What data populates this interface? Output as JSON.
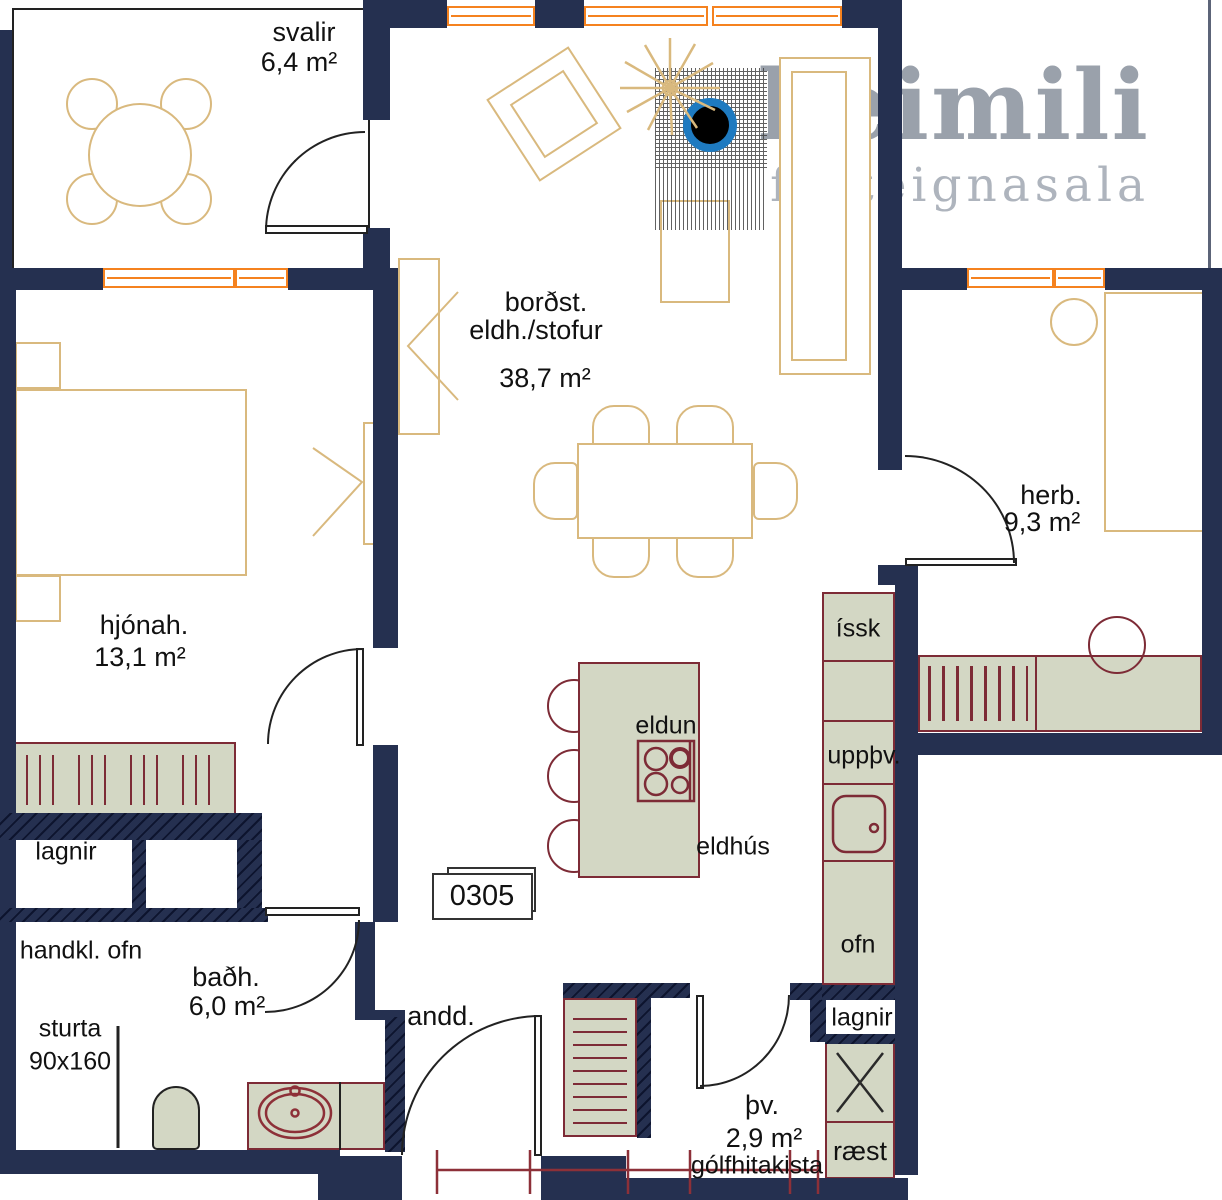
{
  "brand": {
    "name": "heimili",
    "tagline": "fasteignasala"
  },
  "labels": {
    "svalir": "svalir",
    "svalir_area": "6,4 m²",
    "living_1": "borðst.",
    "living_2": "eldh./stofur",
    "living_area": "38,7 m²",
    "hjonah": "hjónah.",
    "hjonah_area": "13,1 m²",
    "herb": "herb.",
    "herb_area": "9,3 m²",
    "badh": "baðh.",
    "badh_area": "6,0 m²",
    "thv": "þv.",
    "thv_area": "2,9 m²",
    "andd": "andd.",
    "issk": "íssk",
    "uppthv": "uppþv.",
    "ofn": "ofn",
    "eldun": "eldun",
    "eldhus": "eldhús",
    "lagnir_left": "lagnir",
    "lagnir_right": "lagnir",
    "handkl_ofn": "handkl. ofn",
    "sturta": "sturta",
    "sturta_size": "90x160",
    "raest": "ræst",
    "golfhitakista": "gólfhitakista",
    "unit": "0305"
  },
  "palette": {
    "wall": "#253050",
    "window": "#f5821f",
    "furniture_outline": "#d9b97e",
    "fixture_fill": "#d3d7c4",
    "fixture_line": "#7d2b36",
    "marker_blue": "#1e7ac0",
    "logo_gray": "#9aa1ab"
  }
}
